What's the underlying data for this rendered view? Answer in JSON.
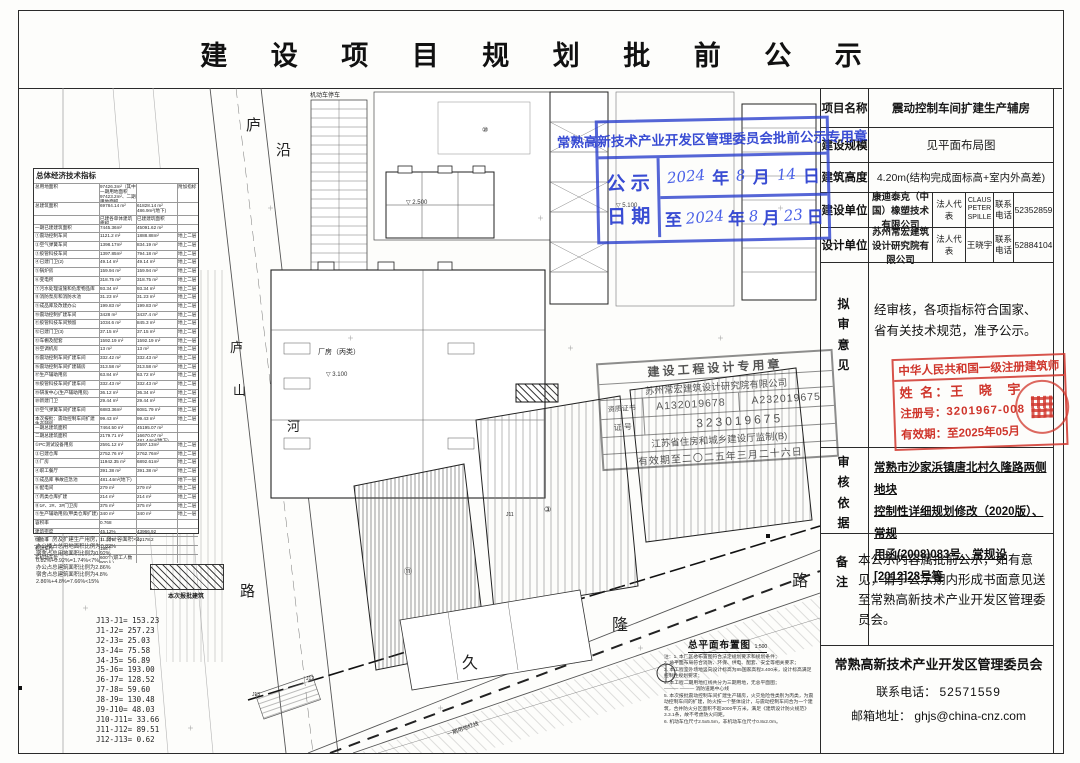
{
  "title": "建 设 项 目 规 划 批 前 公 示",
  "blue_stamp": {
    "header": "常熟高新技术产业开发区管理委员会批前公示专用章",
    "row_label_1": "公 示",
    "row_label_2": "日 期",
    "date1": {
      "y": "2024",
      "y_unit": "年",
      "m": "8",
      "m_unit": "月",
      "d": "14",
      "d_unit": "日"
    },
    "date2": {
      "to": "至",
      "y": "2024",
      "y_unit": "年",
      "m": "8",
      "m_unit": "月",
      "d": "23",
      "d_unit": "日"
    }
  },
  "panel": {
    "rows": [
      {
        "label": "项目名称",
        "value": "震动控制车间扩建生产辅房"
      },
      {
        "label": "建设规模",
        "value": "见平面布局图"
      },
      {
        "label": "建筑高度",
        "value": "4.20m(结构完成面标高+室内外高差)"
      }
    ],
    "units": [
      {
        "label": "建设单位",
        "company": "康迪泰克（中国）橡塑技术有限公司",
        "rep_label": "法人代表",
        "rep": "CLAUS PETER SPILLE",
        "tel_label": "联系 电话",
        "tel": "52352859"
      },
      {
        "label": "设计单位",
        "company": "苏州常宏建筑设计研究院有限公司",
        "rep_label": "法人代表",
        "rep": "王晓宇",
        "tel_label": "联系 电话",
        "tel": "52884104"
      }
    ],
    "review": {
      "label": "拟审意见",
      "text": "经审核，各项指标符合国家、省有关技术规范，准予公示。"
    },
    "basis": {
      "label": "审核依据",
      "lines": [
        "常熟市沙家浜镇唐北村久隆路两侧地块",
        "控制性详细规划修改（2020版）、常规",
        "用函(2008)083号、常规设[2012]28号等"
      ]
    },
    "remark": {
      "label": "备注",
      "text": "本公示内容属批前公示，如有意见，请于公示期内形成书面意见送至常熟高新技术产业开发区管理委员会。"
    },
    "footer": {
      "org": "常熟高新技术产业开发区管理委员会",
      "tel_label": "联系电话：",
      "tel": "52571559",
      "mail_label": "邮箱地址：",
      "mail": "ghjs@china-cnz.com"
    }
  },
  "arch_stamp": {
    "line1": "中华人民共和国一级注册建筑师",
    "name_label": "姓  名：",
    "name": "王 晓 宇",
    "no_label": "注册号：",
    "no": "3201967-008",
    "valid_label": "有效期：",
    "valid": "至2025年05月"
  },
  "design_stamp": {
    "line1": "建设工程设计专用章",
    "line2": "苏州常宏建筑设计研究院有限公司",
    "cert_label": "资质证书",
    "cert1": "A132019678",
    "cert2": "A232019675",
    "no_label": "证 号",
    "no": "323019675",
    "line5": "江苏省住房和城乡建设厅监制(B)",
    "line6": "有效期至二〇二五年三月二十六日"
  },
  "stats": {
    "title": "总体经济技术指标",
    "rows": [
      {
        "n": "总用地面积",
        "v1": "97426.3m²（其中一期用地面积97423.2m²、二期用地面积97423m²）",
        "v2": "",
        "f": "附加指标"
      },
      {
        "n": "总建筑面积",
        "v1": "69784.14 m²",
        "v2": "61828.14 m² 486.9m²(地下)",
        "f": ""
      },
      {
        "n": "",
        "v1": "已建各单体建筑面积",
        "v2": "已建建筑面积",
        "f": ""
      },
      {
        "n": "一期已建建筑面积",
        "v1": "7445.36m²",
        "v2": "45091.62 m²",
        "f": ""
      },
      {
        "n": "①震动控制车间",
        "v1": "1121.2 m²",
        "v2": "1888.88m²",
        "f": "地上二层"
      },
      {
        "n": "②空气弹簧车间",
        "v1": "1398.17m²",
        "v2": "834.19 m²",
        "f": "地上二层"
      },
      {
        "n": "③胶管科技车间",
        "v1": "1397.85m²",
        "v2": "794.18 m²",
        "f": "地上二层"
      },
      {
        "n": "④已建门卫(2)",
        "v1": "49.14 m²",
        "v2": "49.14 m²",
        "f": "地上二层"
      },
      {
        "n": "⑤锅炉房",
        "v1": "159.94 m²",
        "v2": "159.94 m²",
        "f": "地上二层"
      },
      {
        "n": "⑥变电所",
        "v1": "318.75 m²",
        "v2": "318.75 m²",
        "f": "地上二层"
      },
      {
        "n": "⑦污水处理设施和危废物品库",
        "v1": "93.34 m²",
        "v2": "93.34 m²",
        "f": "地上二层"
      },
      {
        "n": "⑧消防泵房和消防水池",
        "v1": "31.23 m²",
        "v2": "31.23 m²",
        "f": "地上二层"
      },
      {
        "n": "⑨成品库及改建办公",
        "v1": "199.83 m²",
        "v2": "199.83 m²",
        "f": "地上二层"
      },
      {
        "n": "⑩震动控制扩建车间",
        "v1": "3428 m²",
        "v2": "3437.4 m²",
        "f": "地上二层"
      },
      {
        "n": "⑪胶管科技车间预留",
        "v1": "1034.6 m²",
        "v2": "845.3 m²",
        "f": "地上二层"
      },
      {
        "n": "⑫已建门卫(3)",
        "v1": "37.15 m²",
        "v2": "37.15 m²",
        "f": "地上二层"
      },
      {
        "n": "⑬车棚及配套",
        "v1": "1592.19 m²",
        "v2": "1592.19 m²",
        "f": "地上一层"
      },
      {
        "n": "⑭空调机房",
        "v1": "13 m²",
        "v2": "13 m²",
        "f": "地上二层"
      },
      {
        "n": "⑮震动控制车间扩建车间",
        "v1": "332.42 m²",
        "v2": "332.43 m²",
        "f": "地上二层"
      },
      {
        "n": "⑯震动控制车间扩建辅房",
        "v1": "313.58 m²",
        "v2": "313.58 m²",
        "f": "地上二层"
      },
      {
        "n": "⑰生产辅助用房",
        "v1": "63.84 m²",
        "v2": "63.72 m²",
        "f": "地上二层"
      },
      {
        "n": "⑱胶管科技车间扩建车间",
        "v1": "332.43 m²",
        "v2": "332.43 m²",
        "f": "地上二层"
      },
      {
        "n": "⑲研发中心(生产辅助用房)",
        "v1": "36.12 m²",
        "v2": "36.34 m²",
        "f": "地上二层"
      },
      {
        "n": "⑳新建门卫",
        "v1": "29.44 m²",
        "v2": "29.44 m²",
        "f": "地上二层"
      },
      {
        "n": "㉑空气弹簧车间扩建车间",
        "v1": "6883.36m²",
        "v2": "6081.79 m²",
        "f": "地上二层"
      },
      {
        "n": "本次报批：震动控制车间扩建生产辅房",
        "v1": "99.43 m²",
        "v2": "99.43 m²",
        "f": "地上二层"
      },
      {
        "n": "一期总建筑面积",
        "v1": "7464.50 m²",
        "v2": "45195.07 m²",
        "f": ""
      },
      {
        "n": "二期总建筑面积",
        "v1": "2179.71 m²",
        "v2": "16670.07 m² 481.44m²(地下)",
        "f": ""
      },
      {
        "n": "①PC测试设备用房",
        "v1": "2591.12 m²",
        "v2": "2597.13m²",
        "f": "地上二层"
      },
      {
        "n": "②已建仓库",
        "v1": "2752.76 m²",
        "v2": "2762.76m²",
        "f": "地上二层"
      },
      {
        "n": "③厂房",
        "v1": "11942.35 m²",
        "v2": "6892.61m²",
        "f": "地上二层"
      },
      {
        "n": "④职工餐厅",
        "v1": "391.38 m²",
        "v2": "391.38 m²",
        "f": "地上二层"
      },
      {
        "n": "⑤成品库 事故应急池",
        "v1": "481.44m²(地下)",
        "v2": "",
        "f": "地下一层"
      },
      {
        "n": "⑥配电间",
        "v1": "279 m²",
        "v2": "279 m²",
        "f": "地上二层"
      },
      {
        "n": "⑦丙类仓库扩建",
        "v1": "214 m²",
        "v2": "214 m²",
        "f": "地上二层"
      },
      {
        "n": "⑧1#、2#、3#门卫房",
        "v1": "375 m²",
        "v2": "375 m²",
        "f": "地上二层"
      },
      {
        "n": "⑨生产辅助用房(甲类仓库扩建)",
        "v1": "340 m²",
        "v2": "340 m²",
        "f": "地上一层"
      },
      {
        "n": "容积率",
        "v1": "0.768",
        "v2": "",
        "f": ""
      },
      {
        "n": "建筑密度",
        "v1": "45.12%",
        "v2": "43966.92",
        "f": ""
      },
      {
        "n": "绿地率",
        "v1": "11.12%",
        "v2": "10178.2",
        "f": ""
      },
      {
        "n": "机动车位",
        "v1": "186个",
        "v2": "",
        "f": ""
      },
      {
        "n": "非机动车位",
        "v1": "600个(职工人数900人)",
        "v2": "",
        "f": ""
      }
    ],
    "notes": [
      "注：厂房及扩建生产用房，厂房计容面积×2，",
      "办公楼占总用地面积比例为0.82%",
      "宿舍占总用地面积比例为0.92%",
      "0.82%+0.92%=1.74%<7%",
      "办公占总建筑面积比例为2.86%",
      "宿舍占总建筑面积比例为4.8%",
      "2.86%+4.8%=7.66%<15%"
    ]
  },
  "legend": {
    "label": "本次报批建筑"
  },
  "j_list": [
    "J13-J1= 153.23",
    "J1-J2= 257.23",
    "J2-J3= 25.03",
    "J3-J4= 75.58",
    "J4-J5= 56.89",
    "J5-J6= 193.00",
    "J6-J7= 128.52",
    "J7-J8= 59.60",
    "J8-J9= 130.48",
    "J9-J10= 48.03",
    "J10-J11= 33.66",
    "J11-J12= 89.51",
    "J12-J13= 0.62"
  ],
  "plan": {
    "title": "总平面布置图",
    "scale": "1:500",
    "notes": [
      "注：1. 本厂区总布置图符合法定规划要求和规划条件；",
      "2. 总平面布局符合消防、环保、供电、配套、安全等相关要求；",
      "3. 本工程室外场地竖向设计标高为85国家高程3.400米，设计标高满足控制性规划要求；",
      "4. 本工程二期用地红线共分为三期用地，无总平面图；",
      "———  ———  消防道路中心线",
      "5. 本次报批震动控制车间扩建生产辅房，火灾危险性类别为丙类，为震动控制车间的扩建，防火按一个整体设计，与震动控制车间合为一个建筑，合并防火分区面积不超2000平方米，满足《建筑设计防火规范》3.3.1条，故不考虑防火间距。",
      "6. 机动车位尺寸2.5x5.5m，非机动车位尺寸0.8x2.0m。"
    ]
  },
  "map": {
    "lu1": "庐",
    "yan": "沿",
    "lu2": "庐",
    "shan": "山",
    "he": "河",
    "lu_road": "路",
    "jiu": "久",
    "long": "隆",
    "lu3": "路",
    "parking": "机动车停车",
    "red_line_label": "一期用地红线",
    "factory_label": "厂房（丙类）",
    "elev1": "▽ 2.500",
    "elev2": "▽ 5.100",
    "elev3": "▽ 3.100",
    "num_top": "⑩",
    "num_left": "⑪",
    "num_mid": "③",
    "j11": "J11",
    "j12": "J12",
    "j13": "J13"
  }
}
